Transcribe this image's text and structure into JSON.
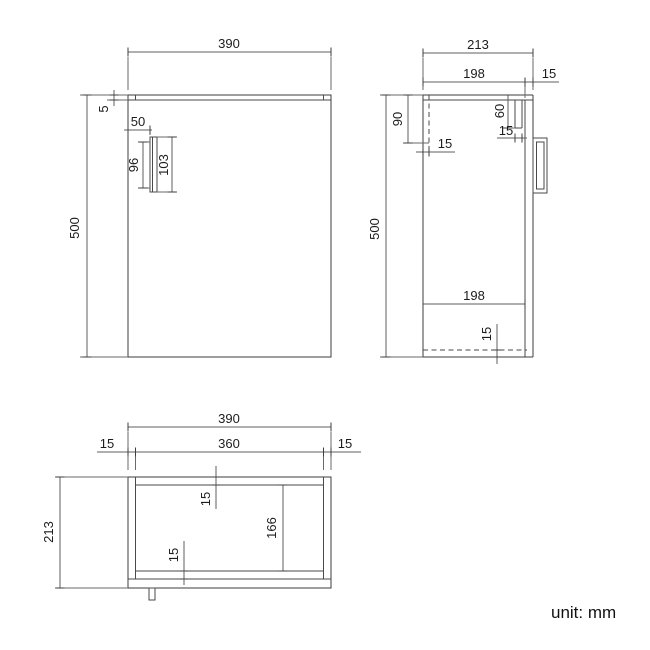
{
  "footer": {
    "unit_label": "unit: mm"
  },
  "front_view": {
    "width": "390",
    "top_thickness": "5",
    "height": "500",
    "handle_offset": "50",
    "handle_inner_height": "96",
    "handle_height": "103"
  },
  "side_view": {
    "depth": "213",
    "carcass_depth": "198",
    "door_thickness": "15",
    "back_inset_height": "90",
    "back_panel_thickness": "15",
    "top_rail_height": "60",
    "top_rail_thickness": "15",
    "height": "500",
    "bottom_panel_length": "198",
    "bottom_panel_thickness": "15"
  },
  "plan_view": {
    "width": "390",
    "inner_width": "360",
    "left_panel_thickness": "15",
    "right_panel_thickness": "15",
    "depth": "213",
    "back_panel_thickness": "15",
    "inner_depth": "166",
    "front_rail_thickness": "15"
  }
}
